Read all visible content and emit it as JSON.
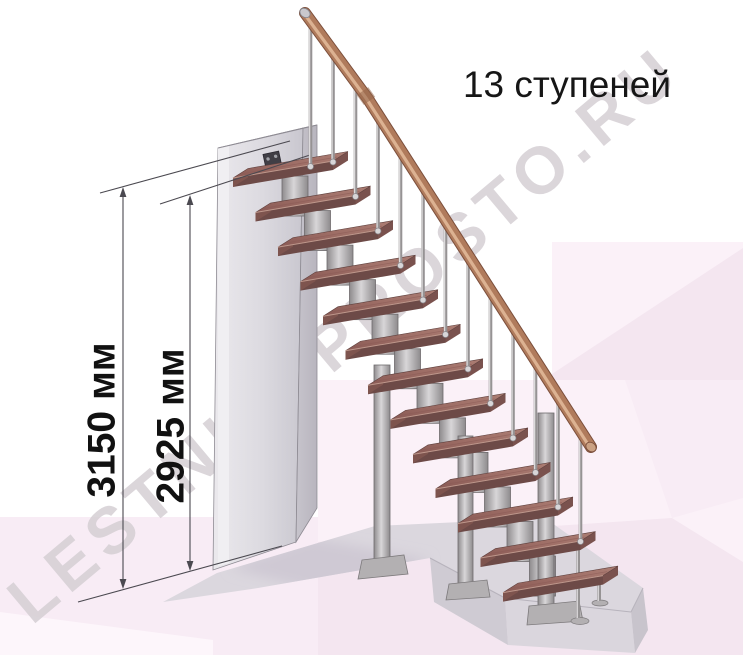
{
  "title": {
    "text": "13 ступеней"
  },
  "watermark": {
    "text": "LESTNICYPROSTO.RU",
    "x": 32,
    "y": 626,
    "angle": -40
  },
  "dimensions": [
    {
      "label": "3150 мм",
      "x": 123,
      "tip_top": 187,
      "tip_bottom": 589,
      "label_cx": 101,
      "label_cy": 420,
      "ext": {
        "x1": 100,
        "y1": 193,
        "x2": 290,
        "y2": 141
      }
    },
    {
      "label": "2925 мм",
      "x": 190,
      "tip_top": 195,
      "tip_bottom": 571,
      "label_cx": 170,
      "label_cy": 426,
      "ext": {
        "x1": 160,
        "y1": 204,
        "x2": 310,
        "y2": 155
      }
    }
  ],
  "baseline": {
    "x1": 78,
    "y1": 602,
    "x2": 282,
    "y2": 546
  },
  "scene": {
    "colors": {
      "pink1": "#f8ecf5",
      "pink2": "#fbf1f8",
      "pink3": "#f4e6f0",
      "pink4": "#fdf6fb",
      "padTop": "#dbd7de",
      "padShadow": "#cfc9d4",
      "slabFront": "#dad6dd",
      "slabLeft": "#cfcbd3",
      "slabRight": "#c8c4cc",
      "slabEdge": "#b7b3bc",
      "wallStrip": "#f0eff2",
      "wallA": "#ebe9ed",
      "wallB": "#dcdae0",
      "wallC": "#c9c7cf",
      "sideA": "#c7c4cc",
      "sideB": "#b8b5be",
      "wallEdge": "#8e8b93",
      "bracket": "#403e45",
      "bracketEdge": "#2a2830",
      "bolt": "#a0a1a7",
      "wood1": "#8a5a55",
      "wood2": "#9f6f67",
      "wood3": "#ac7e74",
      "stepFront": "#6d4a47",
      "stepRight": "#7a524e",
      "stepLeft": "#7e544e",
      "nose": "#bf988c",
      "stepOutline": "#5f413e",
      "metalD": "#8e8b8d",
      "metalL": "#d8d6d8",
      "metalEdge": "#6e6b6d",
      "plate": "#b3b0b2",
      "plateEdge": "#7d7a7c",
      "railMain": "#b07b5c",
      "railHi": "#dcb292",
      "railDark": "#7b4e3b",
      "railCap": "#c9c8cd",
      "railEnd": "#caa183",
      "railJoint": "#96664a",
      "rodD": "#969394",
      "rodL": "#dcdadb",
      "ball": "#d8d6d8",
      "ballEdge": "#8a878c",
      "dim": "#4b4950"
    },
    "background": {
      "polys": [
        {
          "pts": [
            [
              318,
              380
            ],
            [
              743,
              380
            ],
            [
              743,
              655
            ],
            [
              0,
              655
            ],
            [
              0,
              517
            ],
            [
              318,
              517
            ]
          ],
          "fill": "pink1"
        },
        {
          "pts": [
            [
              318,
              380
            ],
            [
              625,
              380
            ],
            [
              672,
              518
            ],
            [
              318,
              542
            ]
          ],
          "fill": "pink2"
        },
        {
          "pts": [
            [
              318,
              542
            ],
            [
              672,
              518
            ],
            [
              743,
              562
            ],
            [
              743,
              655
            ],
            [
              318,
              655
            ]
          ],
          "fill": "pink3"
        },
        {
          "pts": [
            [
              672,
              518
            ],
            [
              743,
              498
            ],
            [
              743,
              562
            ]
          ],
          "fill": "pink2"
        },
        {
          "pts": [
            [
              0,
              612
            ],
            [
              213,
              640
            ],
            [
              213,
              655
            ],
            [
              0,
              655
            ]
          ],
          "fill": "pink4"
        },
        {
          "pts": [
            [
              552,
              242
            ],
            [
              743,
              242
            ],
            [
              743,
              380
            ],
            [
              552,
              380
            ]
          ],
          "fill": "pink2"
        },
        {
          "pts": [
            [
              552,
              374
            ],
            [
              743,
              248
            ],
            [
              743,
              380
            ],
            [
              552,
              380
            ]
          ],
          "fill": "pink3"
        }
      ]
    },
    "floor": {
      "pad": [
        [
          163,
          602
        ],
        [
          217,
          573
        ],
        [
          375,
          526
        ],
        [
          545,
          518
        ],
        [
          643,
          588
        ],
        [
          631,
          612
        ],
        [
          505,
          598
        ],
        [
          430,
          558
        ],
        [
          258,
          588
        ]
      ],
      "shadow": [
        [
          230,
          568
        ],
        [
          312,
          538
        ],
        [
          430,
          560
        ],
        [
          352,
          600
        ]
      ],
      "front": [
        [
          505,
          598
        ],
        [
          631,
          612
        ],
        [
          635,
          653
        ],
        [
          508,
          645
        ]
      ],
      "leftEnd": [
        [
          430,
          558
        ],
        [
          505,
          598
        ],
        [
          508,
          645
        ],
        [
          434,
          602
        ]
      ],
      "rightEnd": [
        [
          631,
          612
        ],
        [
          643,
          588
        ],
        [
          648,
          630
        ],
        [
          635,
          653
        ]
      ],
      "edges": [
        [
          [
            430,
            558
          ],
          [
            505,
            598
          ]
        ],
        [
          [
            505,
            598
          ],
          [
            631,
            612
          ]
        ],
        [
          [
            631,
            612
          ],
          [
            643,
            588
          ]
        ]
      ]
    },
    "wall": {
      "front": [
        [
          218,
          148
        ],
        [
          303,
          128
        ],
        [
          296,
          542
        ],
        [
          213,
          570
        ]
      ],
      "side": [
        [
          303,
          128
        ],
        [
          317,
          125
        ],
        [
          317,
          508
        ],
        [
          296,
          542
        ]
      ],
      "strip": [
        [
          218,
          148
        ],
        [
          229,
          145
        ],
        [
          229,
          563
        ],
        [
          218,
          566
        ]
      ],
      "topEdge": [
        [
          218,
          148
        ],
        [
          317,
          125
        ]
      ],
      "bracket": {
        "cx": 273,
        "cy": 163,
        "w": 16,
        "h": 21,
        "angle": -12,
        "bolts": [
          [
            -4,
            -5
          ],
          [
            4,
            -6
          ],
          [
            -4,
            6
          ],
          [
            4,
            5
          ]
        ]
      }
    },
    "steps": {
      "count": 13,
      "fl": [
        233,
        178
      ],
      "dx": 22.5,
      "dy": 34.55,
      "len": 100,
      "rise": -17,
      "depth": [
        15,
        -9.5
      ],
      "thick": 9,
      "module": {
        "offx": 49,
        "w": 26,
        "offy": -2,
        "h": 40
      }
    },
    "columns": [
      {
        "x": 374,
        "w": 16,
        "top": 365,
        "bottom": 566,
        "plate": [
          [
            362,
            560
          ],
          [
            404,
            555
          ],
          [
            408,
            574
          ],
          [
            358,
            579
          ]
        ]
      },
      {
        "x": 458,
        "w": 15,
        "top": 436,
        "bottom": 590,
        "plate": [
          [
            449,
            584
          ],
          [
            487,
            580
          ],
          [
            490,
            597
          ],
          [
            446,
            600
          ]
        ]
      },
      {
        "x": 538,
        "w": 16,
        "top": 413,
        "bottom": 612,
        "plate": [
          [
            529,
            606
          ],
          [
            579,
            601
          ],
          [
            583,
            621
          ],
          [
            527,
            625
          ]
        ]
      }
    ],
    "legs": [
      {
        "x": 578,
        "y1": 546,
        "y2": 618,
        "bx": 580,
        "by": 621,
        "rx": 9,
        "ry": 3.5
      },
      {
        "x": 599,
        "y1": 578,
        "y2": 601,
        "bx": 600,
        "by": 603,
        "rx": 8,
        "ry": 3
      }
    ],
    "rail": {
      "p0": [
        305,
        13
      ],
      "p1": [
        368,
        99
      ],
      "p2": [
        591,
        447
      ],
      "w": 10,
      "cap": [
        305,
        13
      ],
      "end": [
        591,
        447
      ],
      "joint": [
        366,
        96
      ]
    },
    "balusters": {
      "x0": 310.5,
      "bot0": 168,
      "x1": 333,
      "bot1": 163.5,
      "dx": 22.5,
      "dy": 34.5,
      "count": 13
    }
  }
}
